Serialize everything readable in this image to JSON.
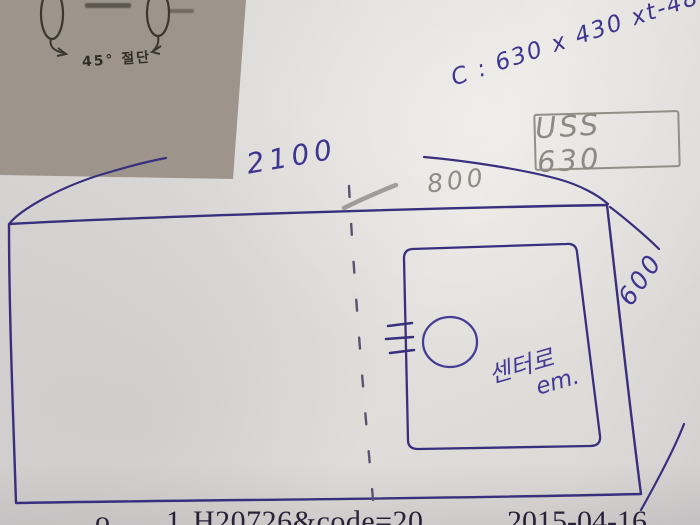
{
  "labels": {
    "spec_note": "C : 630 x 430 xt-48",
    "material": "USS 630",
    "dim_width_total": "2100",
    "dim_width_right": "800",
    "dim_height_right": "600",
    "center_note_line1": "센터로",
    "center_note_line2": "em.",
    "photo_caption": "45° 절단"
  },
  "footer": {
    "fragment1": "o",
    "fragment2": "1.",
    "code": "H20726&code=20",
    "date": "2015-04-16"
  },
  "colors": {
    "pen_blue": "#3d3590",
    "pencil_gray": "#8f8b85",
    "paper": "#dddbd9",
    "photo_ink": "#35302a"
  }
}
